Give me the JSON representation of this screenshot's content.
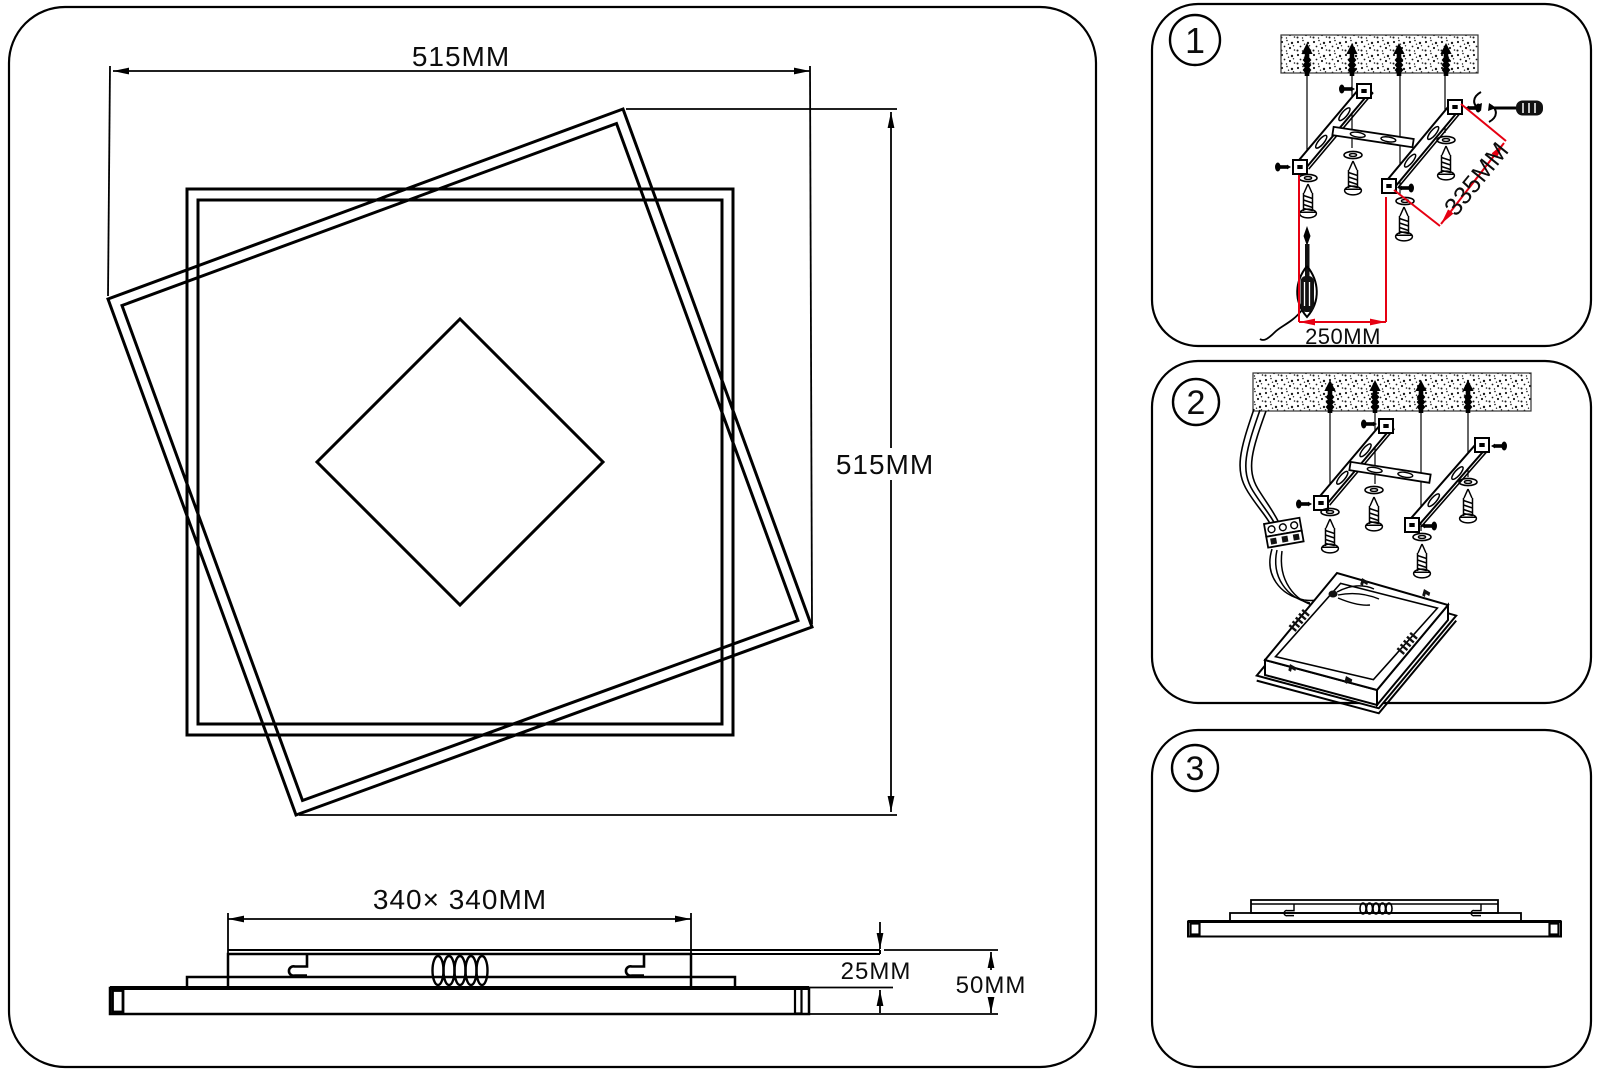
{
  "title": "Ceiling light installation diagram",
  "colors": {
    "ink": "#000000",
    "dimension_red": "#e60012",
    "background": "#ffffff"
  },
  "main_view": {
    "dim_width": "515MM",
    "dim_height": "515MM"
  },
  "side_view": {
    "dim_bracket": "340× 340MM",
    "dim_upper": "25MM",
    "dim_total": "50MM"
  },
  "steps": [
    {
      "number": "1",
      "dim_diagonal": "335MM",
      "dim_spacing": "250MM"
    },
    {
      "number": "2"
    },
    {
      "number": "3"
    }
  ]
}
